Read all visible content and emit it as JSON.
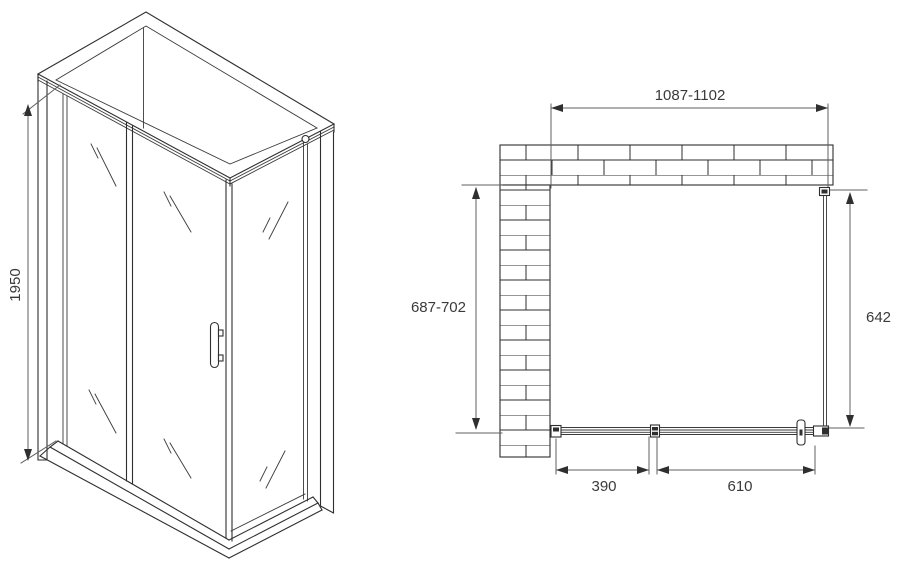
{
  "perspective_view": {
    "height_label": "1950"
  },
  "plan_view": {
    "width_label": "1087-1102",
    "depth_label": "687-702",
    "side_width_label": "642",
    "fixed_panel_label": "390",
    "door_panel_label": "610"
  },
  "colors": {
    "line": "#2f2f2f",
    "dimension_line": "#606060",
    "text": "#3a3a3a",
    "background": "#ffffff"
  }
}
